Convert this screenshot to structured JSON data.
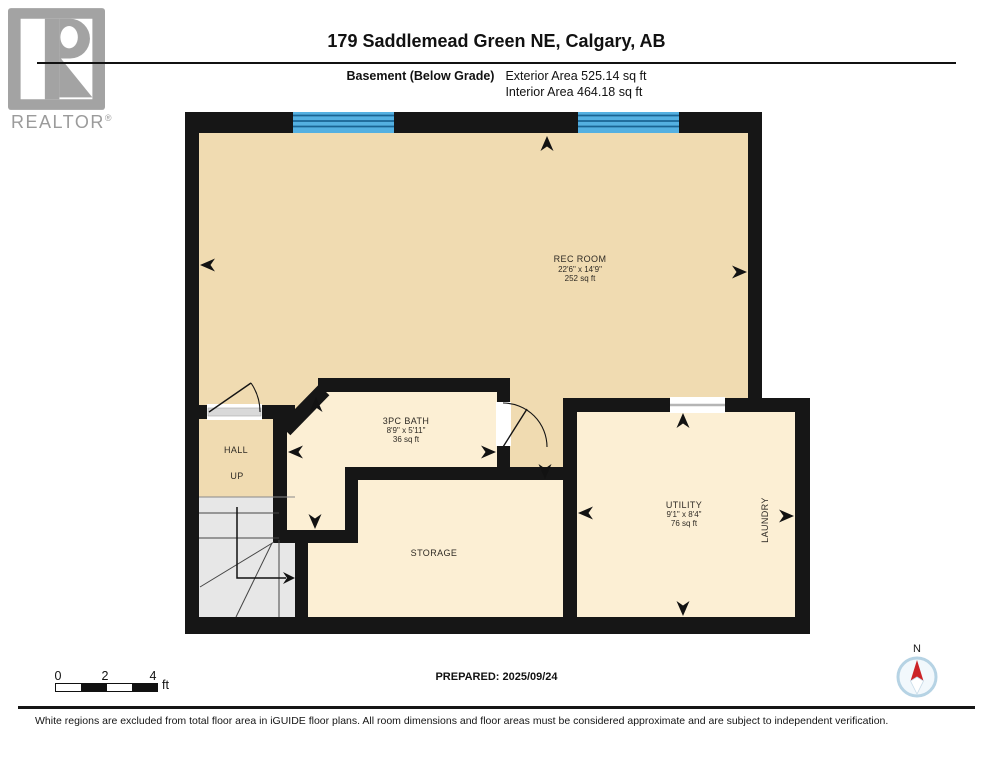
{
  "logo": {
    "realtor_word": "REALTOR",
    "registered_mark": "®"
  },
  "header": {
    "title": "179 Saddlemead Green NE, Calgary, AB",
    "floor_label": "Basement (Below Grade)",
    "exterior_area": "Exterior Area 525.14 sq ft",
    "interior_area": "Interior Area 464.18 sq ft"
  },
  "rooms": {
    "rec_room": {
      "name": "REC ROOM",
      "dimensions": "22'6\" x 14'9\"",
      "area": "252 sq ft"
    },
    "bath": {
      "name": "3PC BATH",
      "dimensions": "8'9\" x 5'11\"",
      "area": "36 sq ft"
    },
    "utility": {
      "name": "UTILITY",
      "dimensions": "9'1\" x 8'4\"",
      "area": "76 sq ft"
    },
    "storage": {
      "name": "STORAGE"
    },
    "hall": {
      "name": "HALL"
    },
    "laundry": {
      "name": "LAUNDRY"
    },
    "stairs": {
      "direction_label": "UP"
    }
  },
  "scale_bar": {
    "tick_0": "0",
    "tick_2": "2",
    "tick_4": "4",
    "unit": "ft"
  },
  "compass": {
    "north_label": "N"
  },
  "footer": {
    "prepared": "PREPARED: 2025/09/24",
    "disclaimer": "White regions are excluded from total floor area in iGUIDE floor plans. All room dimensions and floor areas must be considered approximate and are subject to independent verification."
  },
  "colors": {
    "wall": "#161616",
    "room_fill_tan": "#f0dbb1",
    "room_fill_cream": "#fcefd4",
    "stairs_gray": "#e7e7e7",
    "window_blue": "#54b0e1",
    "window_line_blue": "#1a6494",
    "logo_gray": "#a3a3a3",
    "compass_red": "#cc2327",
    "compass_ring": "#b6d3e4"
  }
}
